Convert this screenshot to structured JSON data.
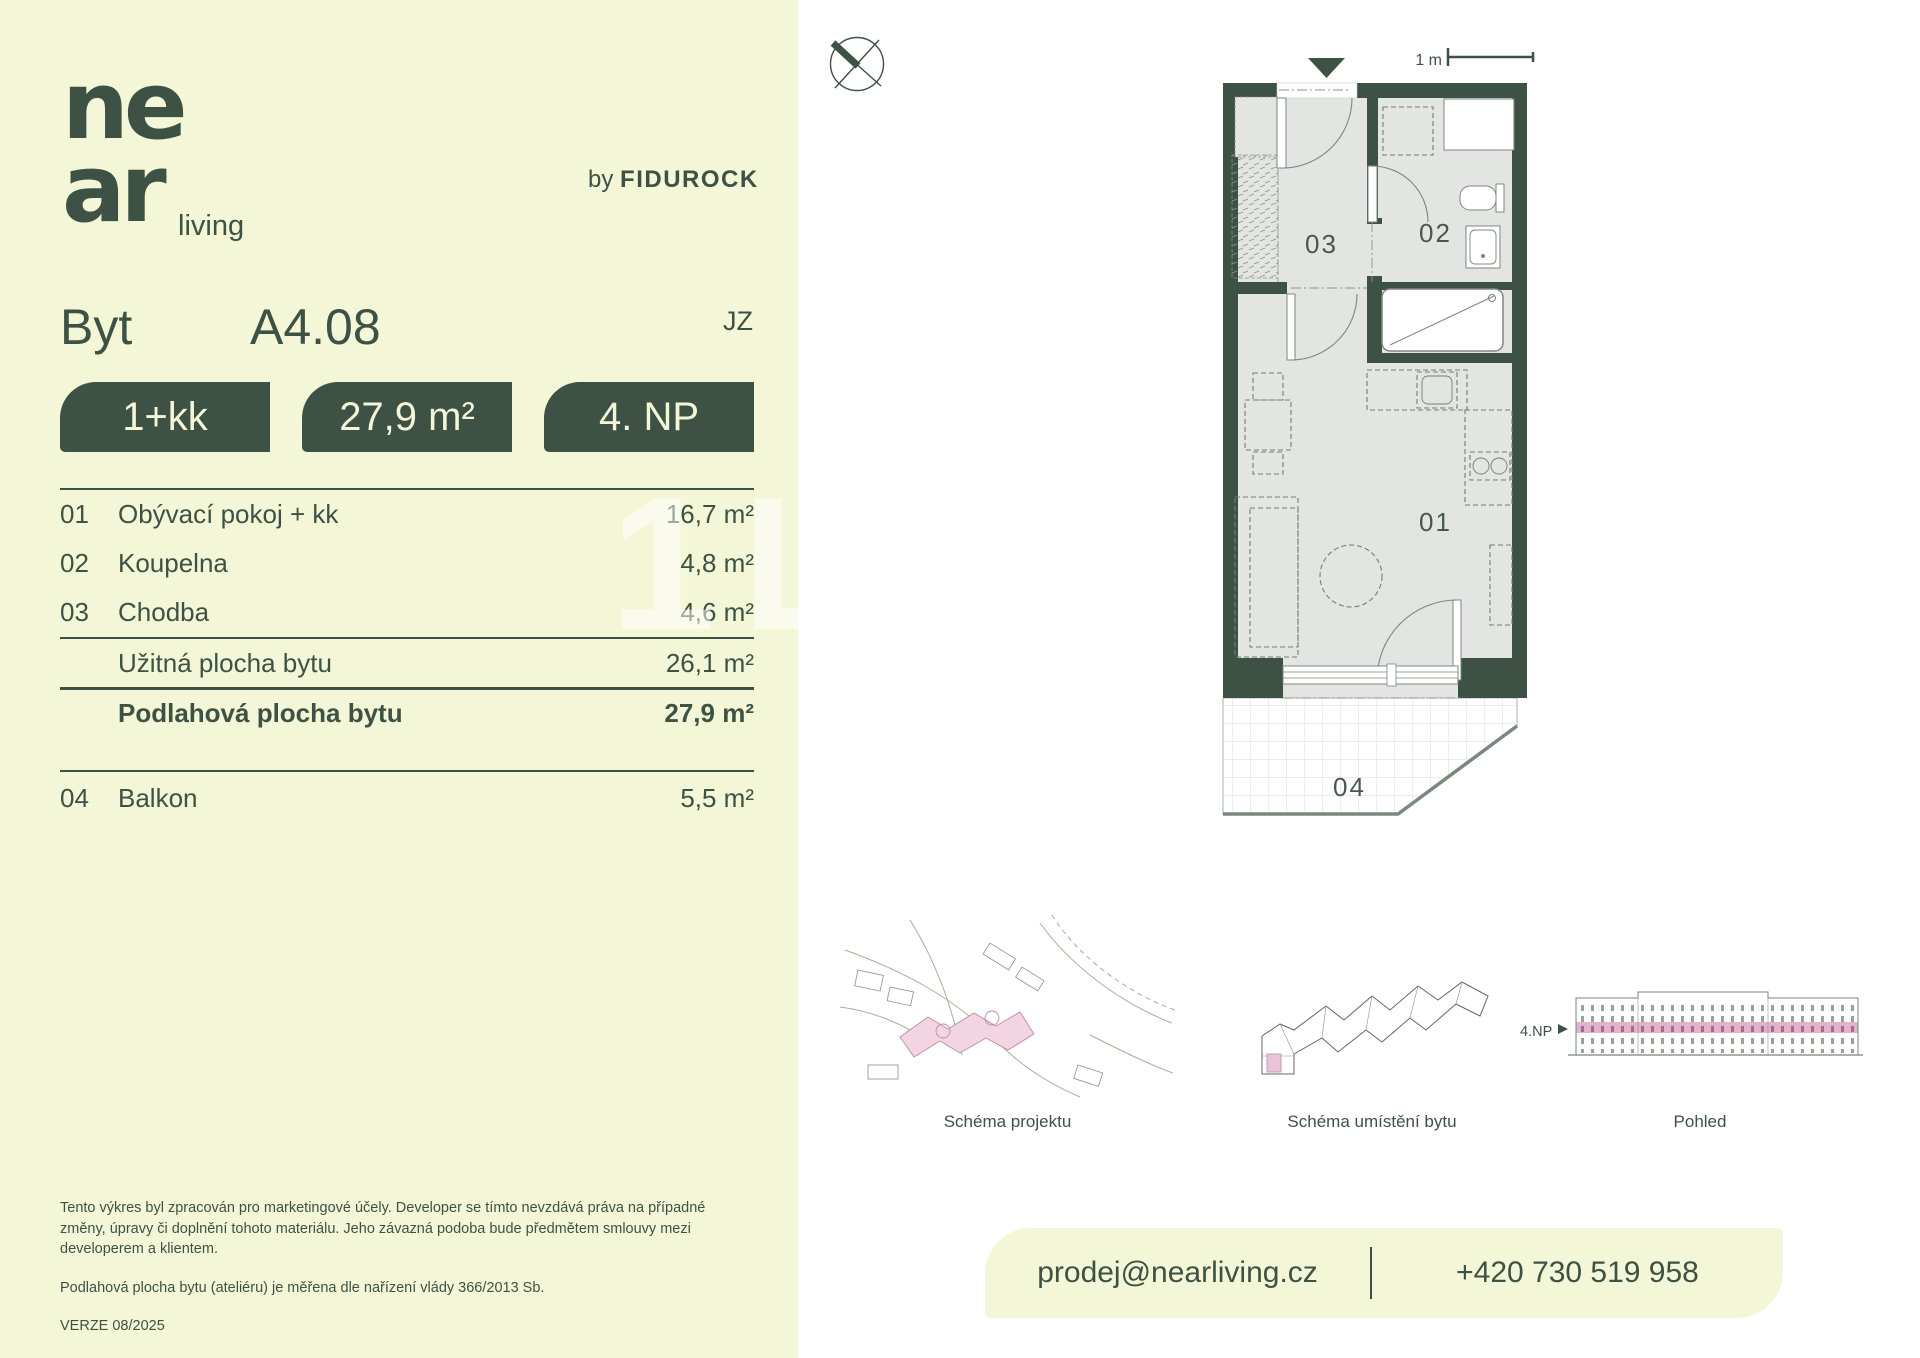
{
  "colors": {
    "green": "#3d5244",
    "cream": "#f4f6d8",
    "floor_gray": "#e3e5e2",
    "pink": "#eecadd"
  },
  "brand": {
    "logo_top": "ne",
    "logo_bottom": "ar",
    "logo_suffix": "living",
    "byline_prefix": "by",
    "byline_name": "FIDUROCK"
  },
  "header": {
    "type_label": "Byt",
    "unit_code": "A4.08",
    "orientation": "JZ"
  },
  "badges": {
    "layout": "1+kk",
    "area": "27,9 m²",
    "floor": "4. NP"
  },
  "area_table": {
    "rooms": [
      {
        "num": "01",
        "name": "Obývací pokoj + kk",
        "area": "16,7 m²"
      },
      {
        "num": "02",
        "name": "Koupelna",
        "area": "4,8 m²"
      },
      {
        "num": "03",
        "name": "Chodba",
        "area": "4,6 m²"
      }
    ],
    "usable": {
      "name": "Užitná plocha bytu",
      "area": "26,1 m²"
    },
    "total": {
      "name": "Podlahová plocha bytu",
      "area": "27,9 m²"
    },
    "balcony": {
      "num": "04",
      "name": "Balkon",
      "area": "5,5 m²"
    }
  },
  "disclaimer": {
    "p1": "Tento výkres byl zpracován pro marketingové účely. Developer se tímto nevzdává práva na případné změny, úpravy či doplnění tohoto materiálu. Jeho závazná podoba bude předmětem smlouvy mezi developerem a klientem.",
    "p2": "Podlahová plocha bytu (ateliéru) je měřena dle nařízení vlády 366/2013 Sb.",
    "version": "VERZE 08/2025"
  },
  "plan": {
    "room01": "01",
    "room02": "02",
    "room03": "03",
    "room04": "04",
    "scale": "1 m"
  },
  "schemes": {
    "project": "Schéma projektu",
    "unit": "Schéma umístění bytu",
    "view": "Pohled",
    "floor_tag": "4.NP"
  },
  "contact": {
    "email": "prodej@nearliving.cz",
    "phone": "+420 730 519 958"
  },
  "watermark": "1L1"
}
